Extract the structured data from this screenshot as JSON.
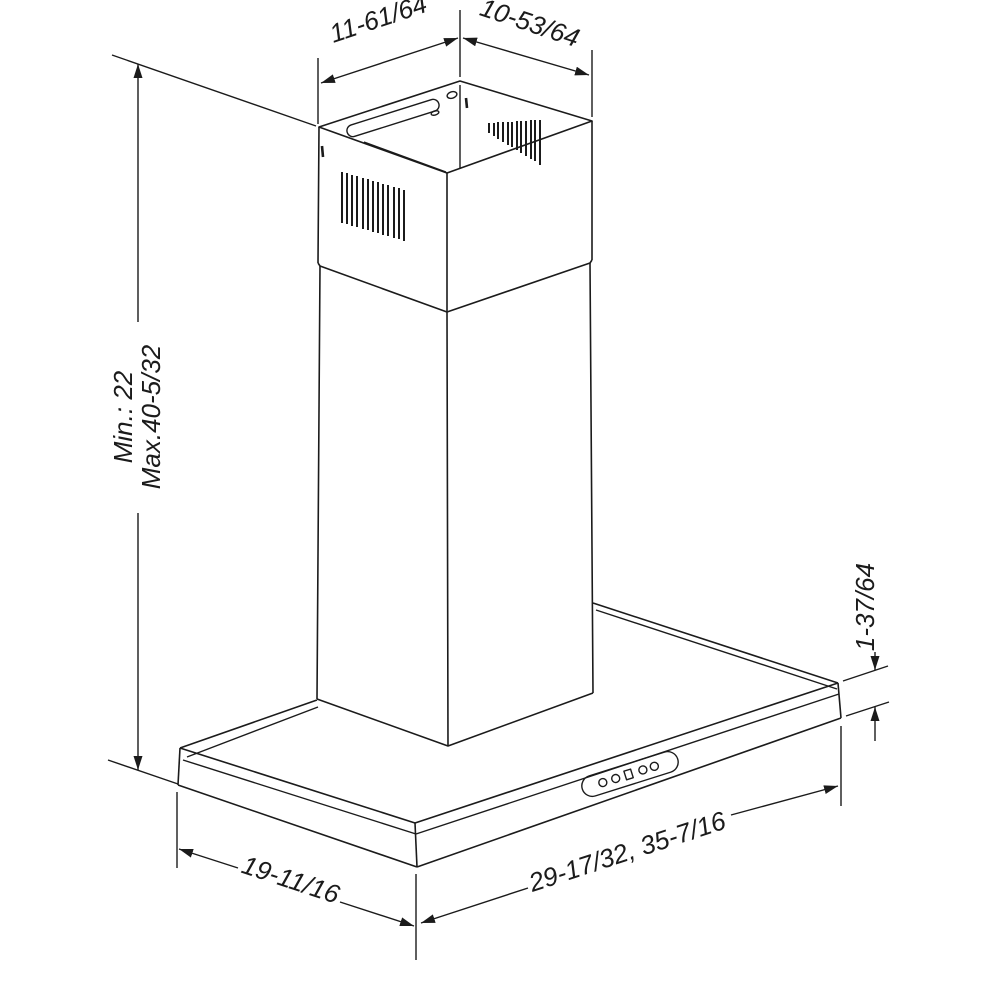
{
  "diagram": {
    "subject": "wall-mount chimney range hood isometric dimensional drawing",
    "background_color": "#ffffff",
    "line_color": "#1b1b1b",
    "labels": {
      "top_depth": "11-61/64",
      "top_width": "10-53/64",
      "height_min": "Min.: 22",
      "height_max": "Max.40-5/32",
      "base_lip_height": "1-37/64",
      "base_depth": "19-11/16",
      "base_widths": "29-17/32, 35-7/16"
    },
    "control_panel": {
      "buttons": [
        "circle",
        "circle",
        "square",
        "circle",
        "circle"
      ]
    }
  }
}
